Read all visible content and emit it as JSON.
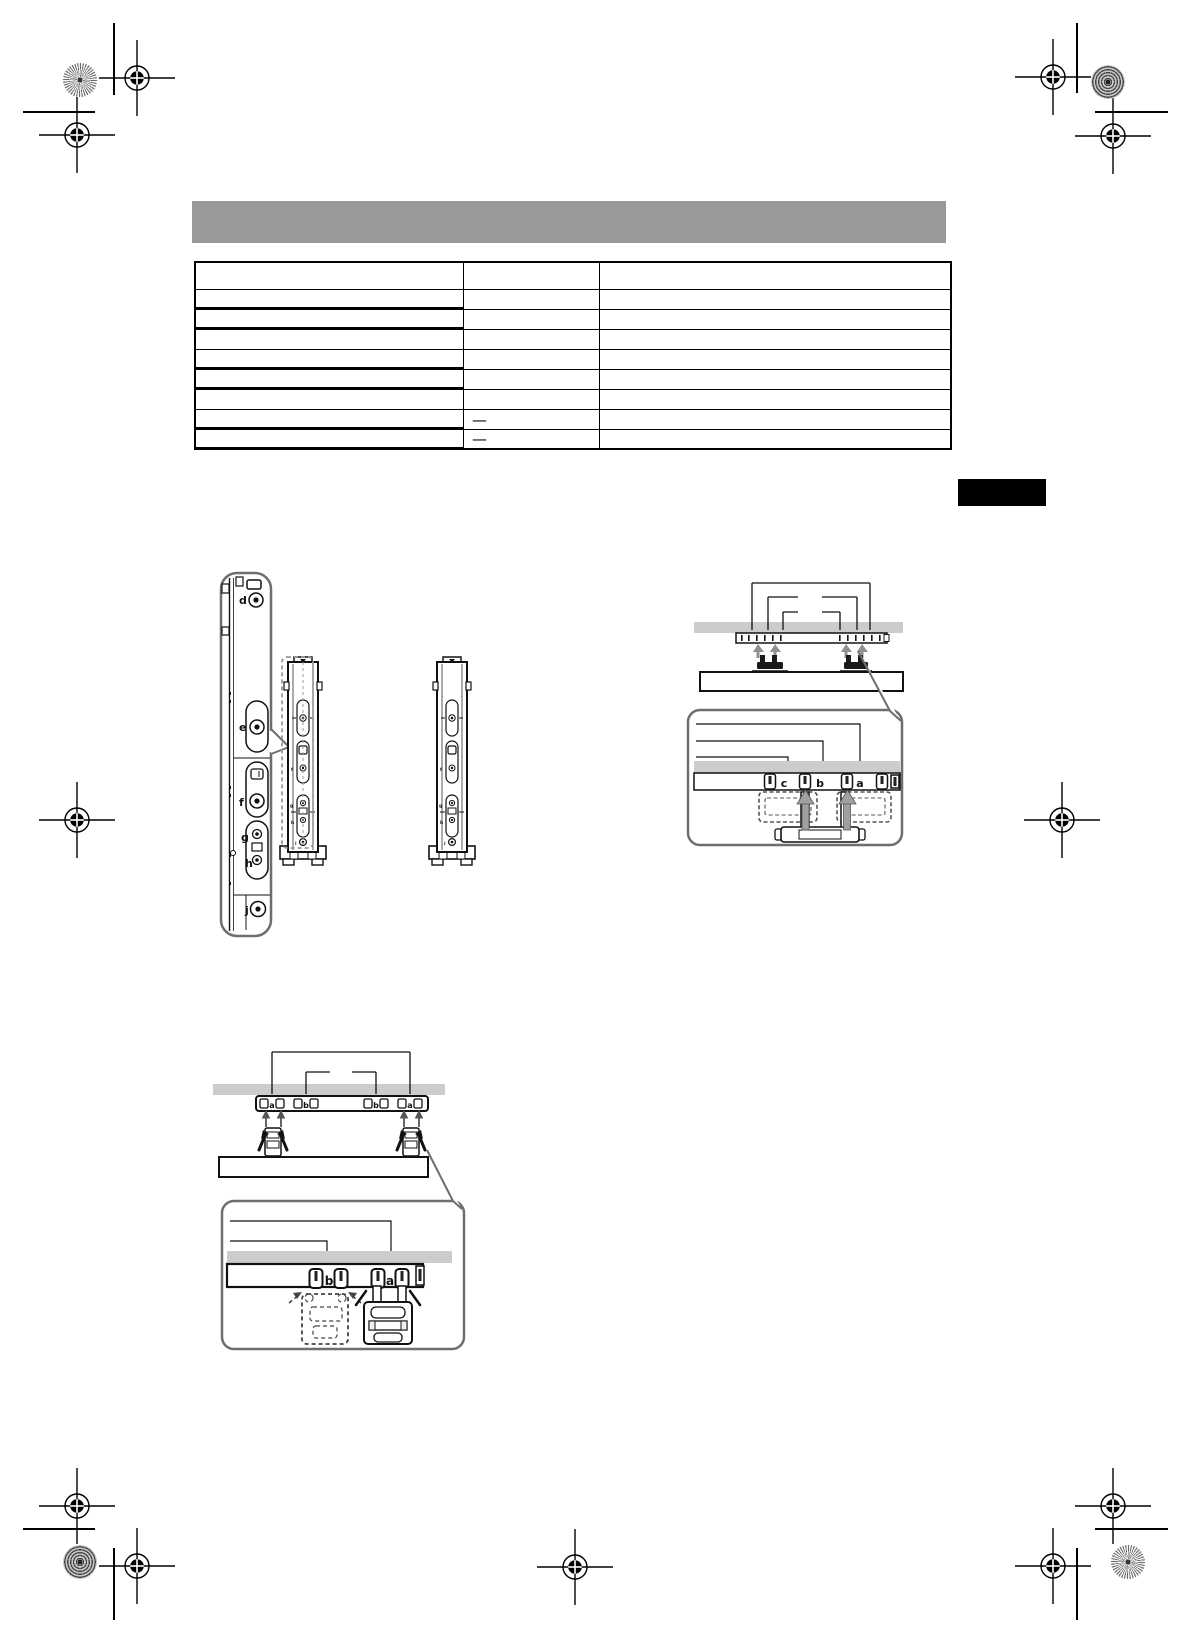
{
  "page": {
    "width": 1190,
    "height": 1644,
    "background": "#ffffff"
  },
  "header_bar": {
    "fill": "#999999"
  },
  "side_tab": {
    "fill": "#000000"
  },
  "spec_table": {
    "columns": 3,
    "rows": [
      [
        "",
        "",
        ""
      ],
      [
        "",
        "",
        ""
      ],
      [
        "",
        "",
        ""
      ],
      [
        "",
        "",
        ""
      ],
      [
        "",
        "",
        ""
      ],
      [
        "",
        "",
        ""
      ],
      [
        "",
        "",
        ""
      ],
      [
        "",
        "—",
        ""
      ],
      [
        "",
        "—",
        ""
      ]
    ]
  },
  "diagrams": {
    "bracket_callout": {
      "labels": [
        "d",
        "e",
        "f",
        "g",
        "h",
        "j"
      ]
    },
    "bracket_tiny_labels": [
      "f",
      "g",
      "h",
      "i"
    ],
    "hook_callout_top": {
      "labels": [
        "c",
        "b",
        "a"
      ]
    },
    "rail_labels_bottom": [
      "a",
      "b",
      "b",
      "a"
    ],
    "hook_callout_bottom": {
      "labels": [
        "b",
        "a"
      ]
    }
  },
  "colors": {
    "line": "#111111",
    "gray_bar": "#cccccc",
    "balloon_border": "#6e6e6e",
    "dashed_outline": "#999999",
    "arrow_gray": "#9a9a9a"
  }
}
